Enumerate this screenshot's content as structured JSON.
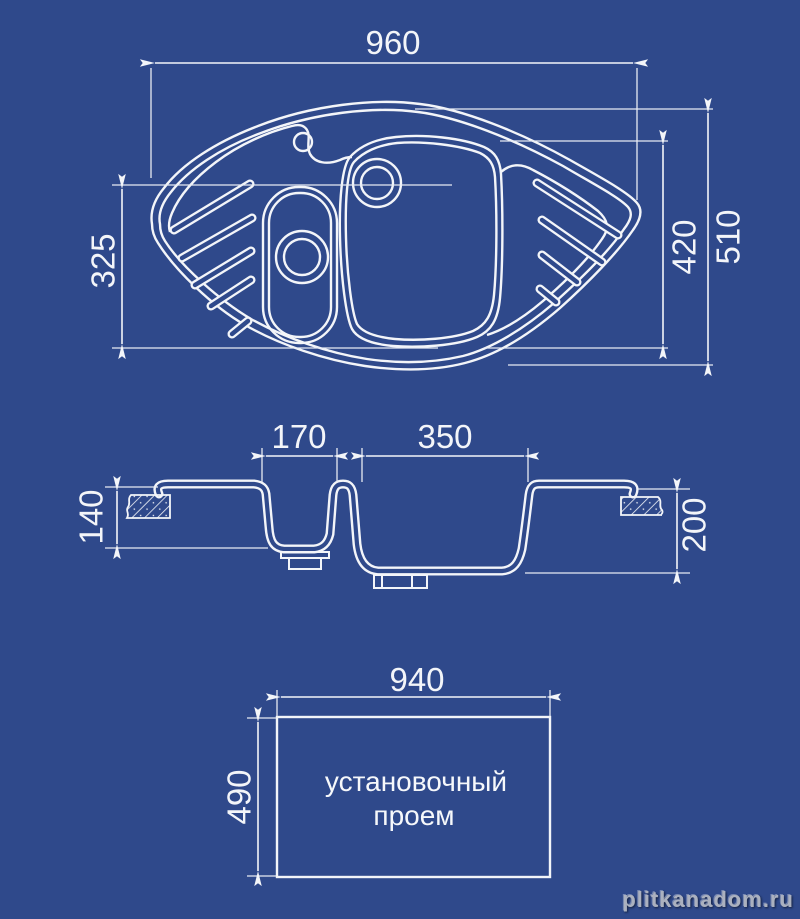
{
  "colors": {
    "background": "#2f498b",
    "line": "#f3f5f9"
  },
  "top_view": {
    "width": "960",
    "overall_depth": "510",
    "main_bowl_depth": "420",
    "small_bowl_zone_depth": "325"
  },
  "section_view": {
    "small_bowl_width": "170",
    "main_bowl_width": "350",
    "small_bowl_depth": "140",
    "main_bowl_depth": "200"
  },
  "cutout_view": {
    "width": "940",
    "depth": "490",
    "label_line1": "установочный",
    "label_line2": "проем"
  },
  "watermark": {
    "text": "plitkanadom.ru"
  }
}
